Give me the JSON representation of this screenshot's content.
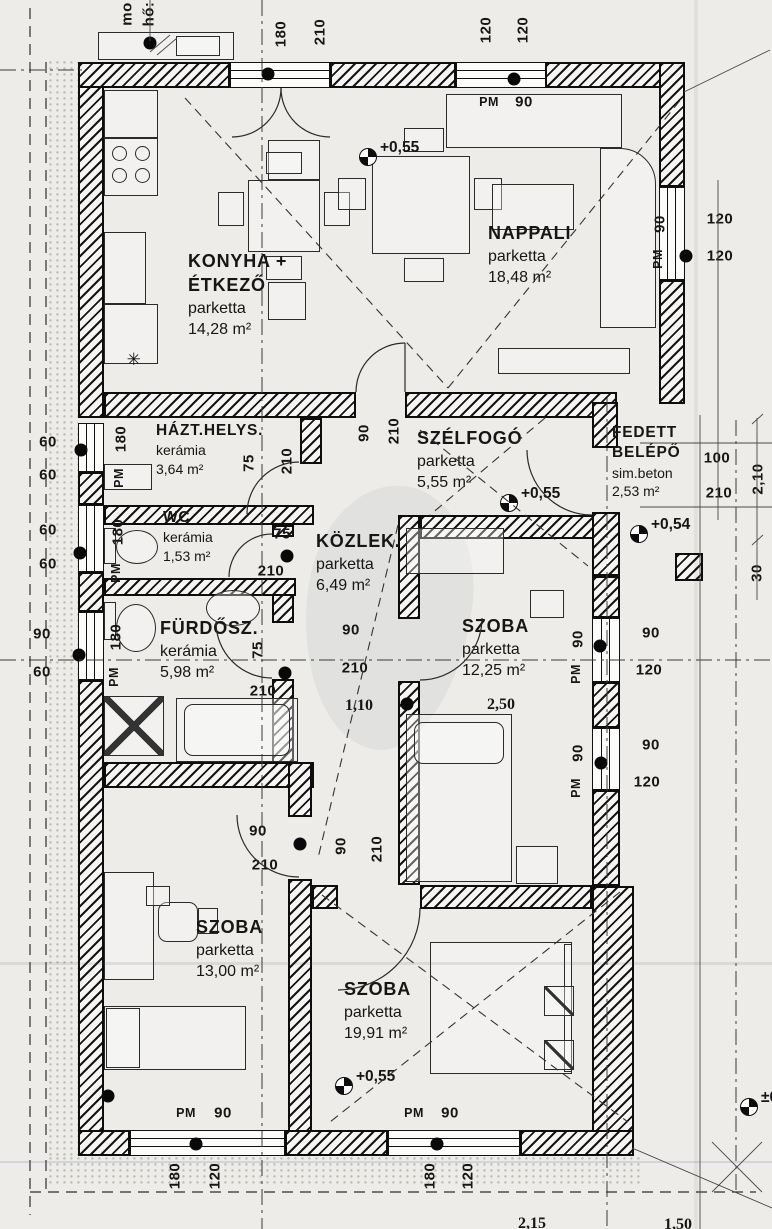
{
  "document": {
    "kind": "scanned floor plan",
    "language": "Hungarian",
    "paper_color": "#edece9",
    "ink_color": "#161616",
    "window_marker_label": "PM"
  },
  "rooms": [
    {
      "name": "KONYHA +",
      "name2": "ÉTKEZŐ",
      "floor": "parketta",
      "area": "14,28 m²",
      "x": 188,
      "y": 250,
      "small": false
    },
    {
      "name": "NAPPALI",
      "name2": "",
      "floor": "parketta",
      "area": "18,48 m²",
      "x": 488,
      "y": 222,
      "small": false
    },
    {
      "name": "HÁZT.HELYS.",
      "name2": "",
      "floor": "kerámia",
      "area": "3,64 m²",
      "x": 156,
      "y": 421,
      "small": true
    },
    {
      "name": "SZÉLFOGÓ",
      "name2": "",
      "floor": "parketta",
      "area": "5,55 m²",
      "x": 417,
      "y": 427,
      "small": false
    },
    {
      "name": "FEDETT",
      "name2": "BELÉPŐ",
      "floor": "sim.beton",
      "area": "2,53 m²",
      "x": 612,
      "y": 423,
      "small": true
    },
    {
      "name": "WC",
      "name2": "",
      "floor": "kerámia",
      "area": "1,53 m²",
      "x": 163,
      "y": 508,
      "small": true
    },
    {
      "name": "KÖZLEK.",
      "name2": "",
      "floor": "parketta",
      "area": "6,49 m²",
      "x": 316,
      "y": 530,
      "small": false
    },
    {
      "name": "FÜRDŐSZ.",
      "name2": "",
      "floor": "kerámia",
      "area": "5,98 m²",
      "x": 160,
      "y": 617,
      "small": false
    },
    {
      "name": "SZOBA",
      "name2": "",
      "floor": "parketta",
      "area": "12,25 m²",
      "x": 462,
      "y": 615,
      "small": false
    },
    {
      "name": "SZOBA",
      "name2": "",
      "floor": "parketta",
      "area": "13,00 m²",
      "x": 196,
      "y": 916,
      "small": false
    },
    {
      "name": "SZOBA",
      "name2": "",
      "floor": "parketta",
      "area": "19,91 m²",
      "x": 344,
      "y": 978,
      "small": false
    }
  ],
  "levels": [
    {
      "label": "+0,55",
      "sx": 368,
      "sy": 157
    },
    {
      "label": "+0,55",
      "sx": 509,
      "sy": 503
    },
    {
      "label": "+0,54",
      "sx": 639,
      "sy": 534
    },
    {
      "label": "+0,55",
      "sx": 344,
      "sy": 1086
    },
    {
      "label": "±0,00",
      "sx": 749,
      "sy": 1107
    }
  ],
  "dims": [
    {
      "t": "mo",
      "x": 127,
      "y": 14,
      "v": 1
    },
    {
      "t": "hő:",
      "x": 149,
      "y": 14,
      "v": 1
    },
    {
      "t": "180",
      "x": 281,
      "y": 34,
      "v": 1
    },
    {
      "t": "210",
      "x": 320,
      "y": 32,
      "v": 1
    },
    {
      "t": "120",
      "x": 486,
      "y": 30,
      "v": 1
    },
    {
      "t": "120",
      "x": 523,
      "y": 30,
      "v": 1
    },
    {
      "t": "90",
      "x": 660,
      "y": 224,
      "v": 1
    },
    {
      "t": "PM",
      "x": 658,
      "y": 259,
      "v": 1,
      "pm": 1
    },
    {
      "t": "180",
      "x": 121,
      "y": 439,
      "v": 1
    },
    {
      "t": "PM",
      "x": 119,
      "y": 478,
      "v": 1,
      "pm": 1
    },
    {
      "t": "180",
      "x": 118,
      "y": 532,
      "v": 1
    },
    {
      "t": "PM",
      "x": 116,
      "y": 573,
      "v": 1,
      "pm": 1
    },
    {
      "t": "180",
      "x": 116,
      "y": 637,
      "v": 1
    },
    {
      "t": "PM",
      "x": 114,
      "y": 677,
      "v": 1,
      "pm": 1
    },
    {
      "t": "75",
      "x": 249,
      "y": 463,
      "v": 1
    },
    {
      "t": "210",
      "x": 287,
      "y": 461,
      "v": 1
    },
    {
      "t": "90",
      "x": 364,
      "y": 433,
      "v": 1
    },
    {
      "t": "210",
      "x": 394,
      "y": 431,
      "v": 1
    },
    {
      "t": "90",
      "x": 578,
      "y": 639,
      "v": 1
    },
    {
      "t": "PM",
      "x": 576,
      "y": 674,
      "v": 1,
      "pm": 1
    },
    {
      "t": "90",
      "x": 578,
      "y": 753,
      "v": 1
    },
    {
      "t": "PM",
      "x": 576,
      "y": 788,
      "v": 1,
      "pm": 1
    },
    {
      "t": "2,10",
      "x": 758,
      "y": 479,
      "v": 1
    },
    {
      "t": "30",
      "x": 757,
      "y": 573,
      "v": 1
    },
    {
      "t": "90",
      "x": 341,
      "y": 846,
      "v": 1
    },
    {
      "t": "210",
      "x": 377,
      "y": 849,
      "v": 1
    },
    {
      "t": "75",
      "x": 258,
      "y": 650,
      "v": 1
    },
    {
      "t": "180",
      "x": 175,
      "y": 1176,
      "v": 1
    },
    {
      "t": "120",
      "x": 215,
      "y": 1176,
      "v": 1
    },
    {
      "t": "180",
      "x": 430,
      "y": 1176,
      "v": 1
    },
    {
      "t": "120",
      "x": 468,
      "y": 1176,
      "v": 1
    },
    {
      "t": "PM",
      "x": 489,
      "y": 102,
      "pm": 1
    },
    {
      "t": "90",
      "x": 524,
      "y": 102
    },
    {
      "t": "120",
      "x": 720,
      "y": 219
    },
    {
      "t": "120",
      "x": 720,
      "y": 256
    },
    {
      "t": "60",
      "x": 48,
      "y": 442
    },
    {
      "t": "60",
      "x": 48,
      "y": 475
    },
    {
      "t": "60",
      "x": 48,
      "y": 530
    },
    {
      "t": "60",
      "x": 48,
      "y": 564
    },
    {
      "t": "90",
      "x": 42,
      "y": 634
    },
    {
      "t": "60",
      "x": 42,
      "y": 672
    },
    {
      "t": "75",
      "x": 282,
      "y": 534
    },
    {
      "t": "210",
      "x": 271,
      "y": 571
    },
    {
      "t": "90",
      "x": 351,
      "y": 630
    },
    {
      "t": "210",
      "x": 355,
      "y": 668
    },
    {
      "t": "1,10",
      "x": 359,
      "y": 706,
      "b": 1
    },
    {
      "t": "2,50",
      "x": 501,
      "y": 705,
      "b": 1
    },
    {
      "t": "210",
      "x": 263,
      "y": 691
    },
    {
      "t": "100",
      "x": 717,
      "y": 458
    },
    {
      "t": "210",
      "x": 719,
      "y": 493
    },
    {
      "t": "90",
      "x": 651,
      "y": 633
    },
    {
      "t": "120",
      "x": 649,
      "y": 670
    },
    {
      "t": "90",
      "x": 651,
      "y": 745
    },
    {
      "t": "120",
      "x": 647,
      "y": 782
    },
    {
      "t": "90",
      "x": 258,
      "y": 831
    },
    {
      "t": "210",
      "x": 265,
      "y": 865
    },
    {
      "t": "PM",
      "x": 186,
      "y": 1113,
      "pm": 1
    },
    {
      "t": "90",
      "x": 223,
      "y": 1113
    },
    {
      "t": "PM",
      "x": 414,
      "y": 1113,
      "pm": 1
    },
    {
      "t": "90",
      "x": 450,
      "y": 1113
    },
    {
      "t": "2,15",
      "x": 532,
      "y": 1224,
      "b": 1
    },
    {
      "t": "1,50",
      "x": 678,
      "y": 1225,
      "b": 1
    },
    {
      "t": "✳",
      "x": 134,
      "y": 360,
      "star": 1
    }
  ],
  "dots": [
    {
      "x": 268,
      "y": 74
    },
    {
      "x": 514,
      "y": 79
    },
    {
      "x": 686,
      "y": 256
    },
    {
      "x": 81,
      "y": 450
    },
    {
      "x": 80,
      "y": 553
    },
    {
      "x": 79,
      "y": 655
    },
    {
      "x": 287,
      "y": 556
    },
    {
      "x": 285,
      "y": 673
    },
    {
      "x": 300,
      "y": 844
    },
    {
      "x": 407,
      "y": 704
    },
    {
      "x": 600,
      "y": 646
    },
    {
      "x": 601,
      "y": 763
    },
    {
      "x": 196,
      "y": 1144
    },
    {
      "x": 437,
      "y": 1144
    },
    {
      "x": 150,
      "y": 43
    },
    {
      "x": 108,
      "y": 1096
    }
  ]
}
